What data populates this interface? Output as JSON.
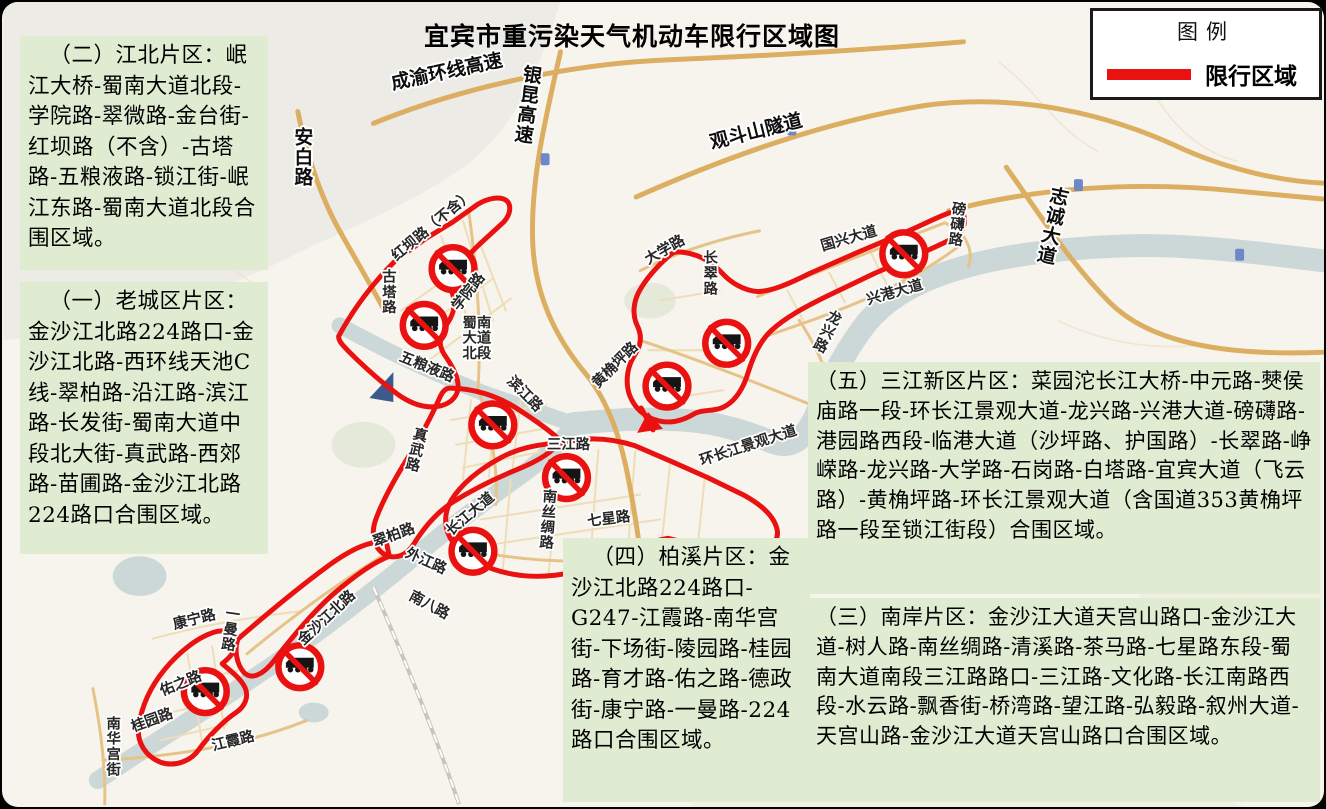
{
  "title": "宜宾市重污染天气机动车限行区域图",
  "legend": {
    "title": "图例",
    "item_label": "限行区域",
    "swatch_color": "#ea1111"
  },
  "info_boxes": [
    {
      "id": "jiangbei",
      "text": "（二）江北片区：岷江大桥-蜀南大道北段-学院路-翠微路-金台街-红坝路（不含）-古塔路-五粮液路-锁江街-岷江东路-蜀南大道北段合围区域。"
    },
    {
      "id": "laocheng",
      "text": "（一）老城区片区：金沙江北路224路口-金沙江北路-西环线天池C线-翠柏路-沿江路-滨江路-长发街-蜀南大道中段北大街-真武路-西郊路-苗圃路-金沙江北路224路口合围区域。"
    },
    {
      "id": "sanjiang",
      "text": "（五）三江新区片区：菜园沱长江大桥-中元路-僰侯庙路一段-环长江景观大道-龙兴路-兴港大道-磅礴路-港园路西段-临港大道（沙坪路、护国路）-长翠路-峥嵘路-龙兴路-大学路-石岗路-白塔路-宜宾大道（飞云路）-黄桷坪路-环长江景观大道（含国道353黄桷坪路一段至锁江街段）合围区域。"
    },
    {
      "id": "nanan",
      "text": "（三）南岸片区：金沙江大道天宫山路口-金沙江大道-树人路-南丝绸路-清溪路-茶马路-七星路东段-蜀南大道南段三江路路口-三江路-文化路-长江南路西段-水云路-飘香街-桥湾路-望江路-弘毅路-叙州大道-天宫山路-金沙江大道天宫山路口合围区域。"
    },
    {
      "id": "baixi",
      "text": "（四）柏溪片区：金沙江北路224路口-G247-江霞路-南华宫街-下场街-陵园路-桂园路-育才路-佑之路-德政街-康宁路-一曼路-224路口合围区域。"
    }
  ],
  "map": {
    "restricted_color": "#ea1111",
    "sign_name": "no-trucks-sign",
    "labels": [
      {
        "t": "成渝环线高速",
        "x": 447,
        "y": 76,
        "rot": -12,
        "hw": true
      },
      {
        "t": "银昆高速",
        "x": 531,
        "y": 80,
        "v": true,
        "rot": 8,
        "hw": true
      },
      {
        "t": "观斗山隧道",
        "x": 758,
        "y": 136,
        "rot": -14,
        "hw": true
      },
      {
        "t": "安白路",
        "x": 302,
        "y": 142,
        "v": true,
        "hw": true
      },
      {
        "t": "志诚大道",
        "x": 1060,
        "y": 202,
        "v": true,
        "rot": 12,
        "hw": true
      },
      {
        "t": "红坝路（不含）",
        "x": 434,
        "y": 228,
        "rot": -40
      },
      {
        "t": "古塔路",
        "x": 388,
        "y": 281,
        "v": true
      },
      {
        "t": "学院路",
        "x": 471,
        "y": 294,
        "rot": -52
      },
      {
        "t": "蜀南\n大道\n北段",
        "x": 476,
        "y": 327
      },
      {
        "t": "五粮液路",
        "x": 424,
        "y": 371,
        "rot": 22
      },
      {
        "t": "滨江路",
        "x": 521,
        "y": 397,
        "rot": 45
      },
      {
        "t": "真武路",
        "x": 418,
        "y": 440,
        "v": true,
        "rot": 14
      },
      {
        "t": "三江路",
        "x": 568,
        "y": 449
      },
      {
        "t": "长江大道",
        "x": 472,
        "y": 518,
        "rot": -40
      },
      {
        "t": "南丝绸路",
        "x": 549,
        "y": 502,
        "v": true,
        "rot": 4
      },
      {
        "t": "七星路",
        "x": 609,
        "y": 524,
        "rot": -7
      },
      {
        "t": "翠柏路",
        "x": 394,
        "y": 540,
        "rot": -20
      },
      {
        "t": "外江路",
        "x": 423,
        "y": 566,
        "rot": 24
      },
      {
        "t": "南八路",
        "x": 426,
        "y": 610,
        "rot": 28
      },
      {
        "t": "金沙江北路",
        "x": 328,
        "y": 622,
        "rot": -43
      },
      {
        "t": "康宁路",
        "x": 193,
        "y": 625,
        "rot": -14
      },
      {
        "t": "一曼路",
        "x": 230,
        "y": 620,
        "v": true,
        "rot": 8
      },
      {
        "t": "佑之路",
        "x": 180,
        "y": 689,
        "rot": -22
      },
      {
        "t": "桂园路",
        "x": 151,
        "y": 726,
        "rot": -20
      },
      {
        "t": "南华宫街",
        "x": 111,
        "y": 730,
        "v": true
      },
      {
        "t": "江霞路",
        "x": 232,
        "y": 747,
        "rot": -14
      },
      {
        "t": "黄桷坪路",
        "x": 618,
        "y": 368,
        "rot": -45
      },
      {
        "t": "大学路",
        "x": 667,
        "y": 253,
        "rot": -30
      },
      {
        "t": "长翠路",
        "x": 711,
        "y": 262,
        "v": true
      },
      {
        "t": "国兴大道",
        "x": 851,
        "y": 242,
        "rot": -16
      },
      {
        "t": "磅礴路",
        "x": 960,
        "y": 213,
        "v": true,
        "rot": 6
      },
      {
        "t": "兴港大道",
        "x": 897,
        "y": 296,
        "rot": -16
      },
      {
        "t": "龙兴路",
        "x": 833,
        "y": 322,
        "v": true,
        "rot": 26
      },
      {
        "t": "环长江景观大道",
        "x": 750,
        "y": 450,
        "rot": -18,
        "size": 15
      }
    ],
    "signs": [
      {
        "x": 452,
        "y": 268
      },
      {
        "x": 423,
        "y": 325
      },
      {
        "x": 492,
        "y": 425
      },
      {
        "x": 566,
        "y": 478
      },
      {
        "x": 667,
        "y": 386
      },
      {
        "x": 472,
        "y": 552
      },
      {
        "x": 905,
        "y": 253
      },
      {
        "x": 727,
        "y": 343
      },
      {
        "x": 203,
        "y": 693
      },
      {
        "x": 298,
        "y": 668
      }
    ]
  }
}
